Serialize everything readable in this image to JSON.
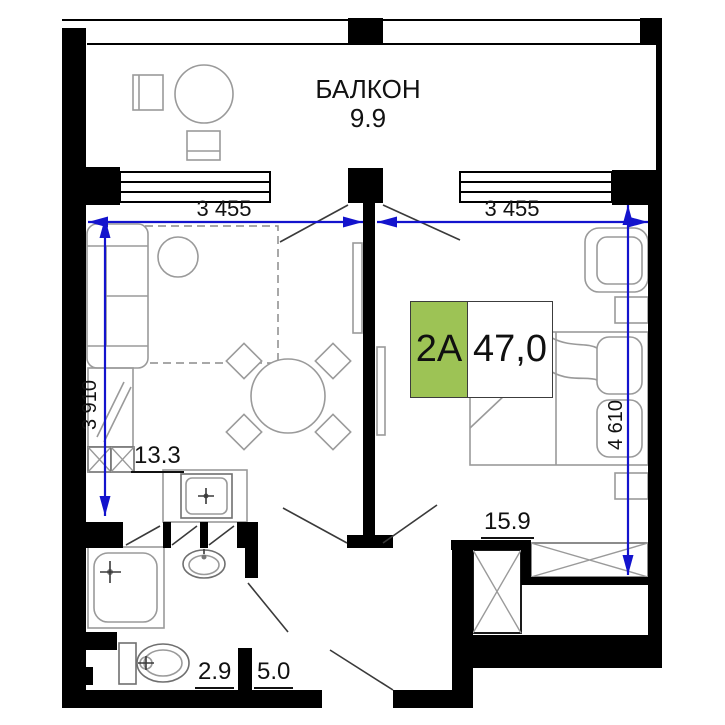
{
  "floorplan": {
    "balcony": {
      "label": "БАЛКОН",
      "area": "9.9"
    },
    "unit_badge": {
      "type": "2A",
      "area": "47,0"
    },
    "room_areas": {
      "kitchen_living": "13.3",
      "bedroom": "15.9",
      "bathroom": "2.9",
      "hallway": "5.0"
    },
    "dimensions": {
      "top_left": "3 455",
      "top_right": "3 455",
      "left_side": "3 910",
      "right_side": "4 610"
    },
    "colors": {
      "walls": "#000000",
      "dimension_blue": "#1313cd",
      "furniture_gray": "#9a9a9a",
      "badge_green": "#9dc355"
    }
  }
}
